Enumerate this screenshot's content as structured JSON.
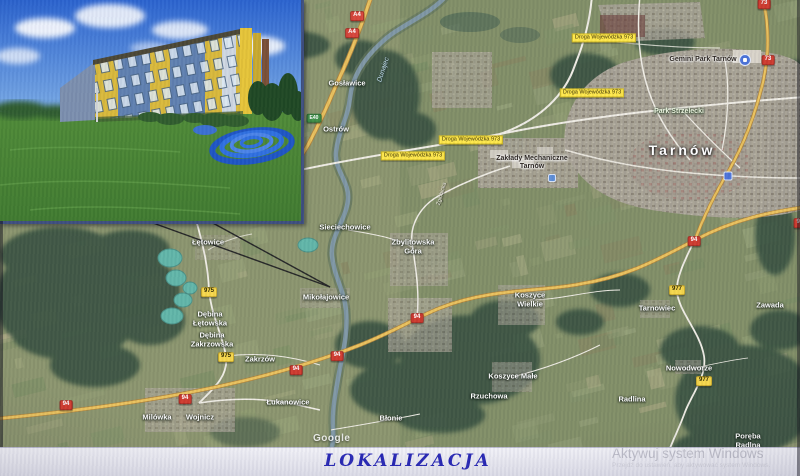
{
  "footer": {
    "title": "LOKALIZACJA"
  },
  "watermarks": {
    "google": "Google",
    "windows_line1": "Aktywuj system Windows",
    "windows_line2": "Przejdź do ustawień, aby aktywować system Windows."
  },
  "map": {
    "labels": [
      {
        "t": "Gosławice",
        "x": 347,
        "y": 84,
        "k": "town"
      },
      {
        "t": "Ostrów",
        "x": 336,
        "y": 130,
        "k": "town"
      },
      {
        "t": "Sieciechowice",
        "x": 345,
        "y": 228,
        "k": "town"
      },
      {
        "t": "Zbylitowska\nGóra",
        "x": 413,
        "y": 247,
        "k": "town"
      },
      {
        "t": "Mikołajowice",
        "x": 326,
        "y": 298,
        "k": "town"
      },
      {
        "t": "Łętowice",
        "x": 208,
        "y": 243,
        "k": "town"
      },
      {
        "t": "Dębina\nŁętowska",
        "x": 210,
        "y": 319,
        "k": "town"
      },
      {
        "t": "Dębina\nZakrzowska",
        "x": 212,
        "y": 340,
        "k": "town"
      },
      {
        "t": "Zakrzów",
        "x": 260,
        "y": 360,
        "k": "town"
      },
      {
        "t": "Łukanowice",
        "x": 288,
        "y": 403,
        "k": "town"
      },
      {
        "t": "Milówka",
        "x": 157,
        "y": 418,
        "k": "town"
      },
      {
        "t": "Wojnicz",
        "x": 200,
        "y": 418,
        "k": "town"
      },
      {
        "t": "Błonie",
        "x": 391,
        "y": 419,
        "k": "town"
      },
      {
        "t": "Rzuchowa",
        "x": 489,
        "y": 397,
        "k": "town"
      },
      {
        "t": "Koszyce\nWielkie",
        "x": 530,
        "y": 300,
        "k": "town"
      },
      {
        "t": "Koszyce Małe",
        "x": 513,
        "y": 377,
        "k": "town"
      },
      {
        "t": "Tarnowiec",
        "x": 657,
        "y": 309,
        "k": "town"
      },
      {
        "t": "Zawada",
        "x": 770,
        "y": 306,
        "k": "town"
      },
      {
        "t": "Nowodworze",
        "x": 689,
        "y": 369,
        "k": "town"
      },
      {
        "t": "Radlina",
        "x": 632,
        "y": 400,
        "k": "town"
      },
      {
        "t": "Poręba Radlna",
        "x": 748,
        "y": 441,
        "k": "town"
      },
      {
        "t": "Tarnów",
        "x": 682,
        "y": 150,
        "k": "city"
      },
      {
        "t": "Gemini Park Tarnów",
        "x": 703,
        "y": 60,
        "k": "poi"
      },
      {
        "t": "Zakłady Mechaniczne\nTarnów",
        "x": 532,
        "y": 163,
        "k": "poi"
      },
      {
        "t": "Park Strzelecki",
        "x": 679,
        "y": 112,
        "k": "park"
      },
      {
        "t": "Dunajec",
        "x": 384,
        "y": 70,
        "k": "water",
        "r": -72
      },
      {
        "t": "Zgłobicka",
        "x": 442,
        "y": 194,
        "k": "street",
        "r": -74
      }
    ],
    "road_labels": [
      {
        "t": "Droga Wojewódzka 973",
        "x": 604,
        "y": 38
      },
      {
        "t": "Droga Wojewódzka 973",
        "x": 592,
        "y": 93
      },
      {
        "t": "Droga Wojewódzka 973",
        "x": 471,
        "y": 140
      },
      {
        "t": "Droga Wojewódzka 973",
        "x": 413,
        "y": 156
      }
    ],
    "shields": [
      {
        "t": "A4",
        "x": 357,
        "y": 16,
        "k": "mw"
      },
      {
        "t": "A4",
        "x": 352,
        "y": 33,
        "k": "mw"
      },
      {
        "t": "E40",
        "x": 314,
        "y": 118,
        "k": "eu"
      },
      {
        "t": "73",
        "x": 764,
        "y": 4,
        "k": "nat"
      },
      {
        "t": "73",
        "x": 768,
        "y": 60,
        "k": "nat"
      },
      {
        "t": "94",
        "x": 66,
        "y": 405,
        "k": "nat"
      },
      {
        "t": "94",
        "x": 185,
        "y": 399,
        "k": "nat"
      },
      {
        "t": "94",
        "x": 417,
        "y": 318,
        "k": "nat"
      },
      {
        "t": "94",
        "x": 337,
        "y": 356,
        "k": "nat"
      },
      {
        "t": "94",
        "x": 296,
        "y": 370,
        "k": "nat"
      },
      {
        "t": "94",
        "x": 694,
        "y": 241,
        "k": "nat"
      },
      {
        "t": "94",
        "x": 800,
        "y": 223,
        "k": "nat"
      },
      {
        "t": "975",
        "x": 209,
        "y": 292,
        "k": "voi"
      },
      {
        "t": "975",
        "x": 226,
        "y": 357,
        "k": "voi"
      },
      {
        "t": "977",
        "x": 677,
        "y": 290,
        "k": "voi"
      },
      {
        "t": "977",
        "x": 704,
        "y": 381,
        "k": "voi"
      }
    ],
    "pins": [
      {
        "k": "shopping-pin",
        "x": 745,
        "y": 60
      },
      {
        "k": "factory-pin",
        "x": 552,
        "y": 178
      },
      {
        "k": "transit-pin",
        "x": 728,
        "y": 176
      }
    ]
  },
  "colors": {
    "road_label_yellow": "#ffe84a",
    "shield_national_red": "#cf3a2d",
    "shield_voivodeship_yellow": "#f7d84b",
    "title_blue": "#2727b5",
    "building_yellow": "#d9b93a",
    "building_blue": "#5f80b0",
    "lake_turquoise": "#55b7a6"
  }
}
